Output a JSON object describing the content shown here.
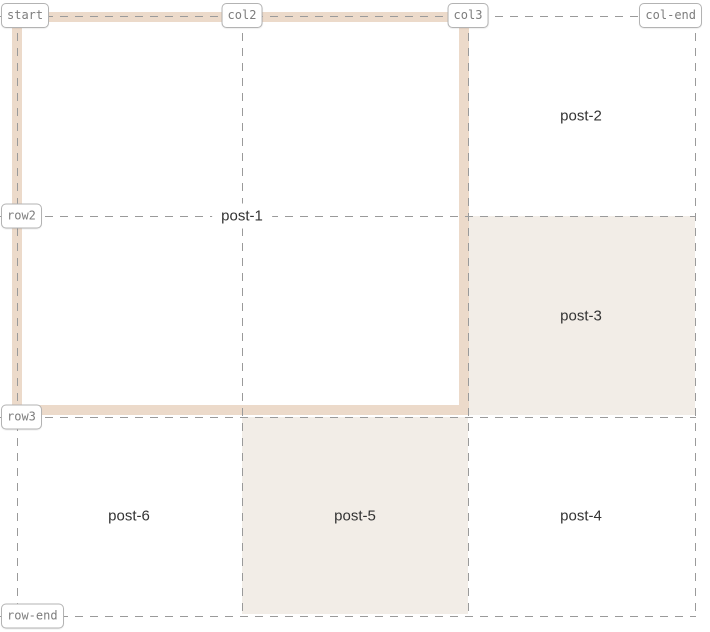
{
  "overlay": {
    "line_labels": {
      "start": "start",
      "col2": "col2",
      "col3": "col3",
      "col_end": "col-end",
      "row2": "row2",
      "row3": "row3",
      "row_end": "row-end"
    },
    "areas": {
      "post1": "post-1",
      "post2": "post-2",
      "post3": "post-3",
      "post4": "post-4",
      "post5": "post-5",
      "post6": "post-6"
    },
    "colors": {
      "highlight_border": "#ecdaca",
      "area_fill": "#f2ede7",
      "dashed_line": "#9a9a9a",
      "line_label_text": "#7d7d7d",
      "line_label_border": "#b3b3b3",
      "area_label_text": "#333333",
      "background": "#ffffff"
    }
  }
}
